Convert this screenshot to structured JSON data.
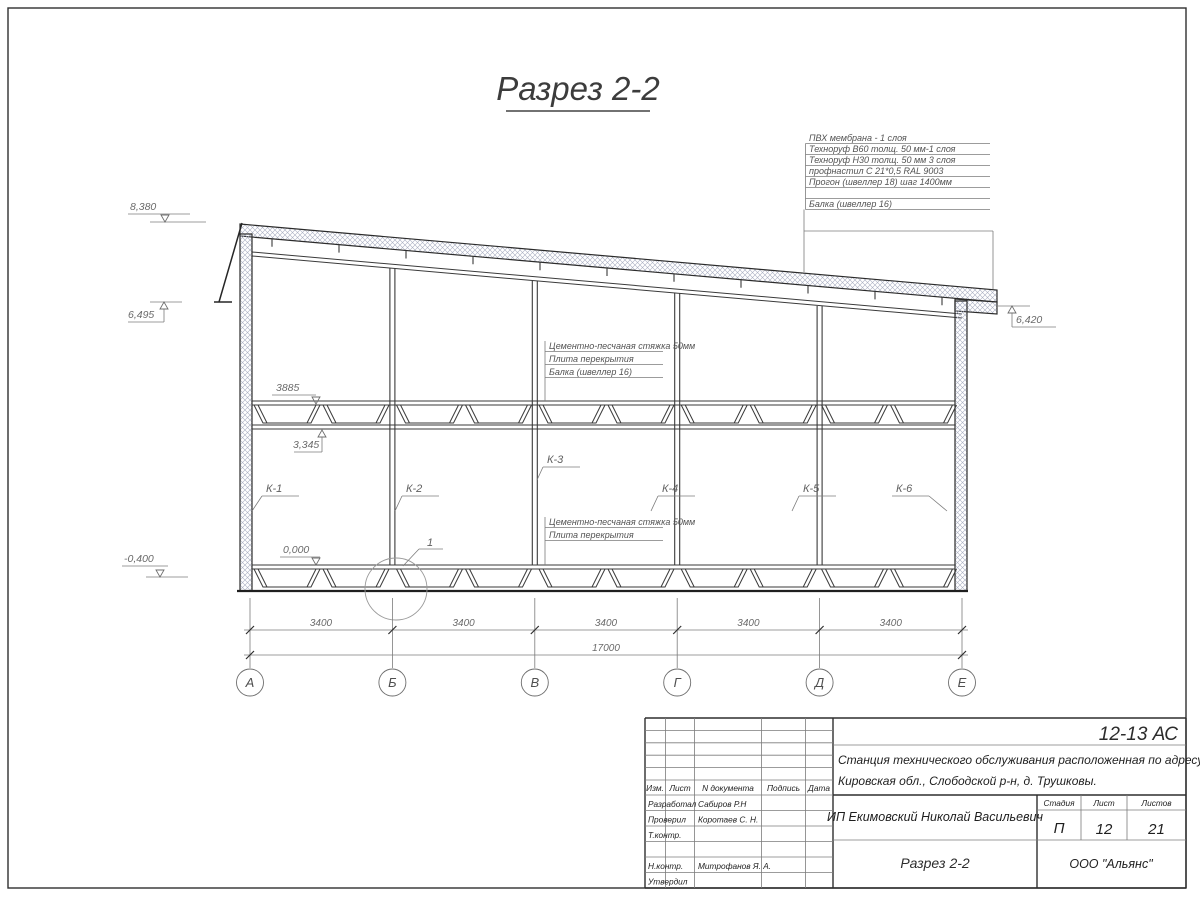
{
  "sheet": {
    "title": "Разрез 2-2"
  },
  "roof_spec": {
    "items": [
      "ПВХ мембрана - 1 слоя",
      "Техноруф В60 толщ. 50 мм-1 слоя",
      "Техноруф Н30 толщ. 50 мм 3 слоя",
      "профнастил С 21*0,5 RAL 9003",
      "Прогон (швеллер 18) шаг 1400мм",
      "Балка (швеллер 16)"
    ]
  },
  "ceiling_spec": {
    "items": [
      "Цементно-песчаная стяжка 50мм",
      "Плита перекрытия",
      "Балка (швеллер 16)"
    ]
  },
  "floor_spec": {
    "items": [
      "Цементно-песчаная стяжка 50мм",
      "Плита перекрытия"
    ]
  },
  "elevations": {
    "roof_high": "8,380",
    "eave_left": "6,495",
    "eave_right": "6,420",
    "ceiling": "3885",
    "beam": "3,345",
    "floor": "0,000",
    "ground": "-0,400"
  },
  "columns": {
    "labels": [
      "К-1",
      "К-2",
      "К-3",
      "К-4",
      "К-5",
      "К-6"
    ]
  },
  "detail": {
    "number": "1"
  },
  "dimensions": {
    "bays": [
      "3400",
      "3400",
      "3400",
      "3400",
      "3400"
    ],
    "total": "17000"
  },
  "axes": {
    "labels": [
      "А",
      "Б",
      "В",
      "Г",
      "Д",
      "Е"
    ]
  },
  "title_block": {
    "code": "12-13 АС",
    "project_line1": "Станция технического обслуживания расположенная по адресу",
    "project_line2": "Кировская обл., Слободской р-н, д. Трушковы.",
    "client": "ИП Екимовский Николай Васильевич",
    "sheet_name": "Разрез 2-2",
    "company": "ООО \"Альянс\"",
    "cols": {
      "izm": "Изм.",
      "list": "Лист",
      "doc": "N документа",
      "sign": "Подпись",
      "date": "Дата"
    },
    "roles": [
      {
        "label": "Разработал",
        "name": "Сабиров Р.Н"
      },
      {
        "label": "Проверил",
        "name": "Коротаев С. Н."
      },
      {
        "label": "Т.контр.",
        "name": ""
      },
      {
        "label": "Н.контр.",
        "name": "Митрофанов Я. А."
      },
      {
        "label": "Утвердил",
        "name": ""
      }
    ],
    "stage": {
      "header_stage": "Стадия",
      "header_sheet": "Лист",
      "header_sheets": "Листов",
      "stage_value": "П",
      "sheet_value": "12",
      "sheets_value": "21"
    }
  }
}
